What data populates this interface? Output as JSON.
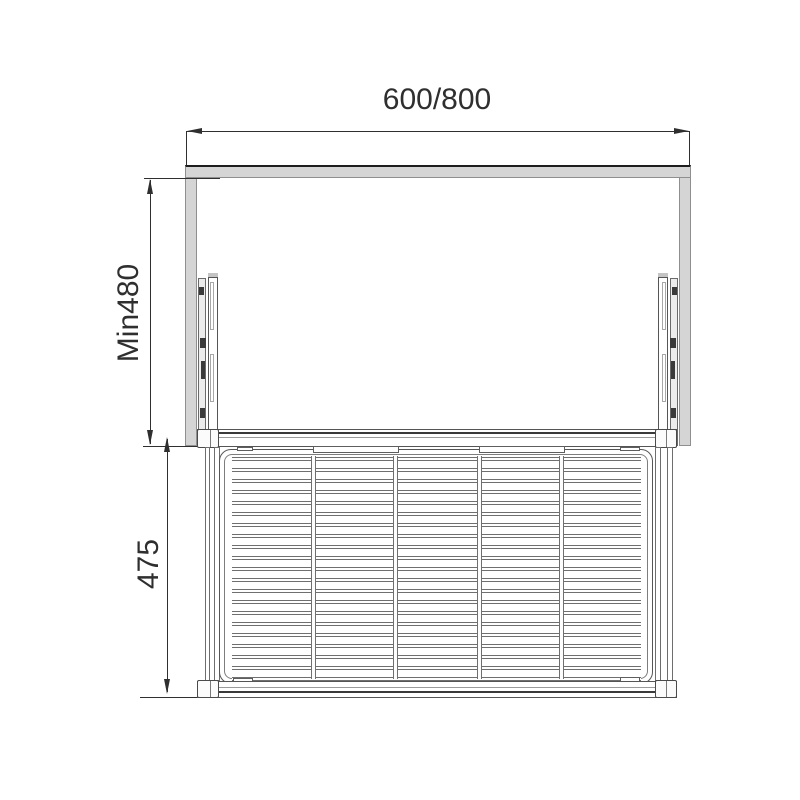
{
  "title": "Pull-out wire basket installation dimension diagram",
  "dimensions": {
    "cabinet_width": {
      "label": "600/800"
    },
    "min_inner_height": {
      "label": "Min480"
    },
    "unit_height": {
      "label": "475"
    }
  },
  "colors": {
    "dimension_line": "#2f2f2f",
    "drawing_line": "#555555",
    "panel_fill": "#d5d5d5",
    "background": "#ffffff"
  },
  "basket_grid": {
    "h_wires": 21,
    "h_start_y": 457,
    "h_spacing": 11.0,
    "v_wire_x": [
      311,
      393,
      477,
      559
    ]
  }
}
